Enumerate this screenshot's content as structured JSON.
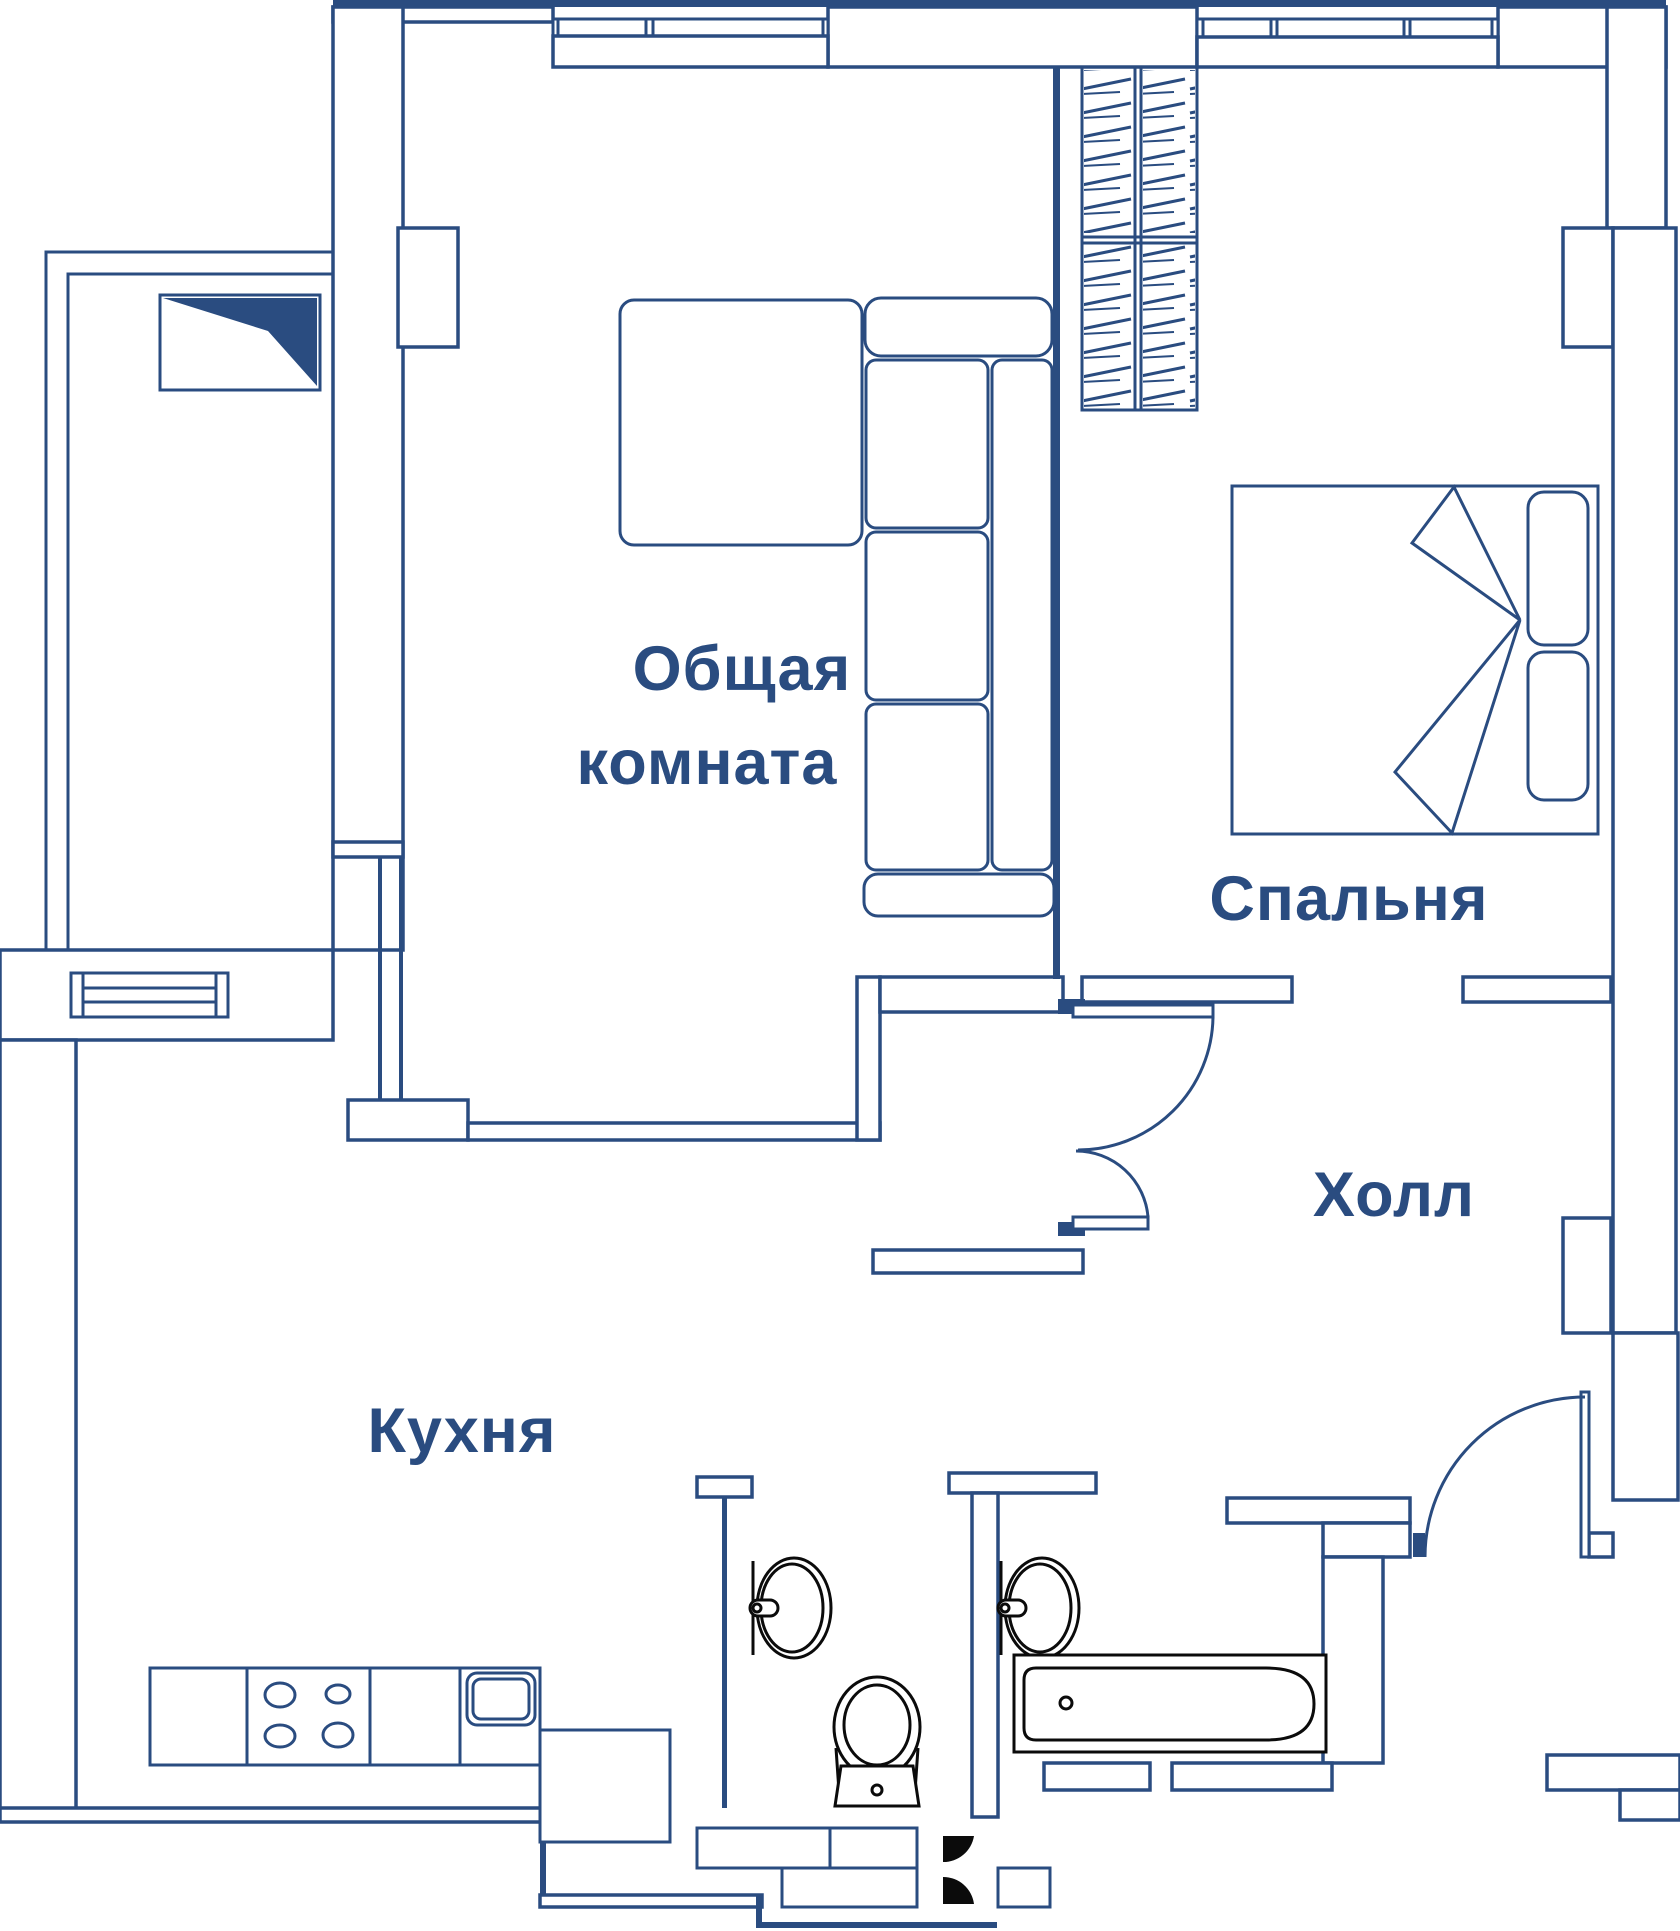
{
  "floor_plan": {
    "type": "apartment-blueprint",
    "language": "ru",
    "rooms": {
      "living": {
        "label_line1": "Общая",
        "label_line2": "комната"
      },
      "bedroom": {
        "label": "Спальня"
      },
      "hall": {
        "label": "Холл"
      },
      "kitchen": {
        "label": "Кухня"
      }
    },
    "furniture_symbols": [
      "wardrobe-hatched",
      "double-bed-with-pillows",
      "corner-sofa",
      "square-table",
      "tv-unit",
      "kitchen-counter-with-stove-and-sink",
      "bathtub",
      "toilet",
      "wash-basin-wc",
      "wash-basin-bathroom",
      "hall-cabinets",
      "balcony-rail"
    ],
    "doors": [
      "living-hall-double-door",
      "entry-door",
      "wc-door",
      "bathroom-door"
    ],
    "colors": {
      "wall_blue": "#2a4c80",
      "fixture_black": "#0b0b0b",
      "background": "#ffffff"
    }
  }
}
